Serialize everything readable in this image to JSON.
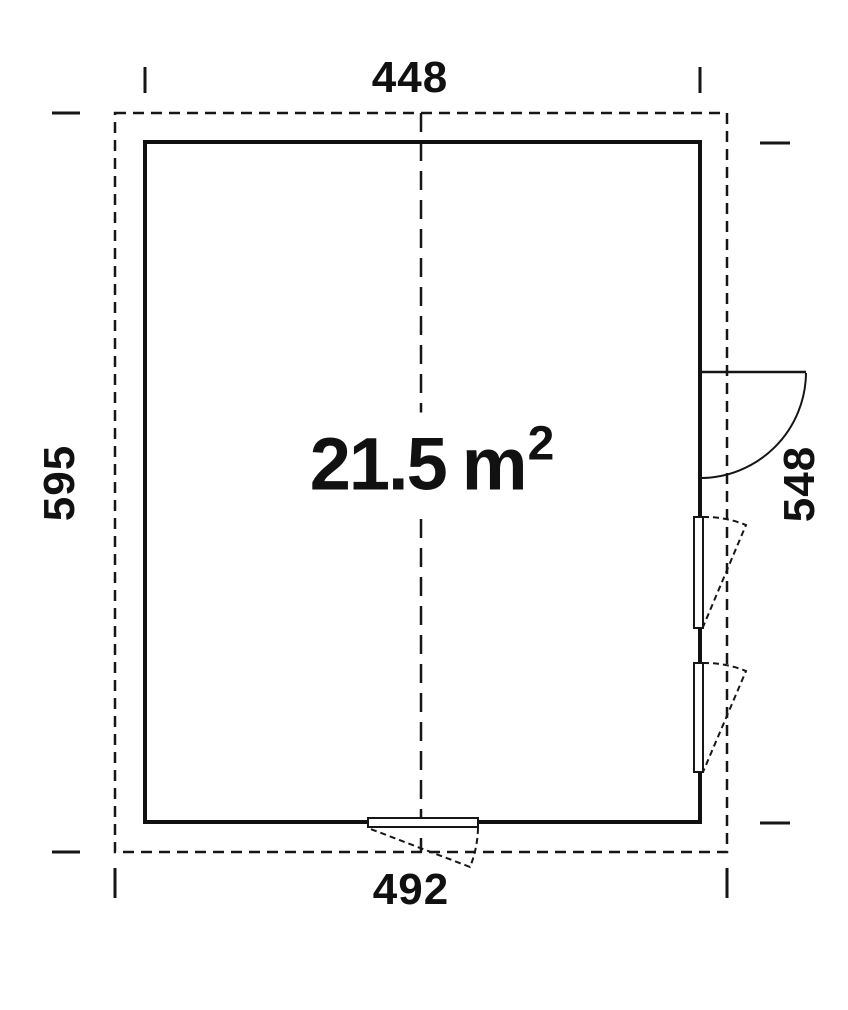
{
  "diagram": {
    "type": "floor-plan",
    "area": {
      "value": "21.5",
      "unit": "m",
      "exponent": "2"
    },
    "dimensions": {
      "top": "448",
      "bottom": "492",
      "left": "595",
      "right": "548"
    },
    "features": {
      "roof_outline": "dashed rectangle 492 x 595",
      "wall_outline": "solid rectangle 448 x 548",
      "door": "right wall, swings outward",
      "windows": [
        "right-wall-upper",
        "right-wall-lower",
        "bottom-wall"
      ]
    },
    "colors": {
      "line": "#161616",
      "background": "#ffffff"
    }
  }
}
